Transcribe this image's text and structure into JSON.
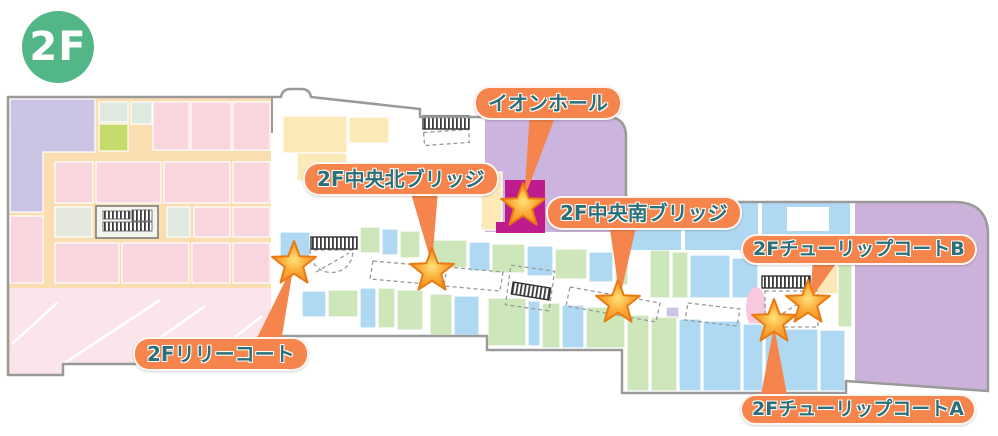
{
  "floor_badge": {
    "label": "2F"
  },
  "annotations": {
    "aeon_hall": {
      "text": "イオンホール"
    },
    "north_bridge": {
      "text": "2F中央北ブリッジ"
    },
    "south_bridge": {
      "text": "2F中央南ブリッジ"
    },
    "tulip_b": {
      "text": "2FチューリップコートB"
    },
    "lily": {
      "text": "2Fリリーコート"
    },
    "tulip_a": {
      "text": "2FチューリップコートA"
    }
  },
  "markers": {
    "count": 6,
    "style": "star-marker"
  },
  "icons": {
    "escalator": "escalator-icon",
    "elevator": "elevator-icon"
  },
  "colors": {
    "label_bg": "#F5854C",
    "label_text": "#2B6F79",
    "badge_bg": "#53B687",
    "badge_text": "#FFFFFF",
    "star_fill": "#F89C1E",
    "star_stroke": "#E97A12",
    "outline_gray": "#9A9A9A",
    "hall_purple": "#CBB4DE",
    "right_purple": "#CBB2DA",
    "magenta": "#BE1C8C",
    "zone_pink": "#F9D5DE",
    "zone_pink_light": "#FBE5EA",
    "corridor_peach": "#FBDDB2",
    "zone_lavender": "#CBC4E4",
    "zone_blue": "#AFD9F2",
    "zone_green": "#CDE7BA",
    "zone_cream": "#FCE9B8",
    "zone_yellowgreen": "#C6DC6A",
    "zone_graygreen": "#DFE9DF",
    "zone_gray": "#E4E8DD",
    "zone_pink_oval": "#F7C8DE"
  }
}
